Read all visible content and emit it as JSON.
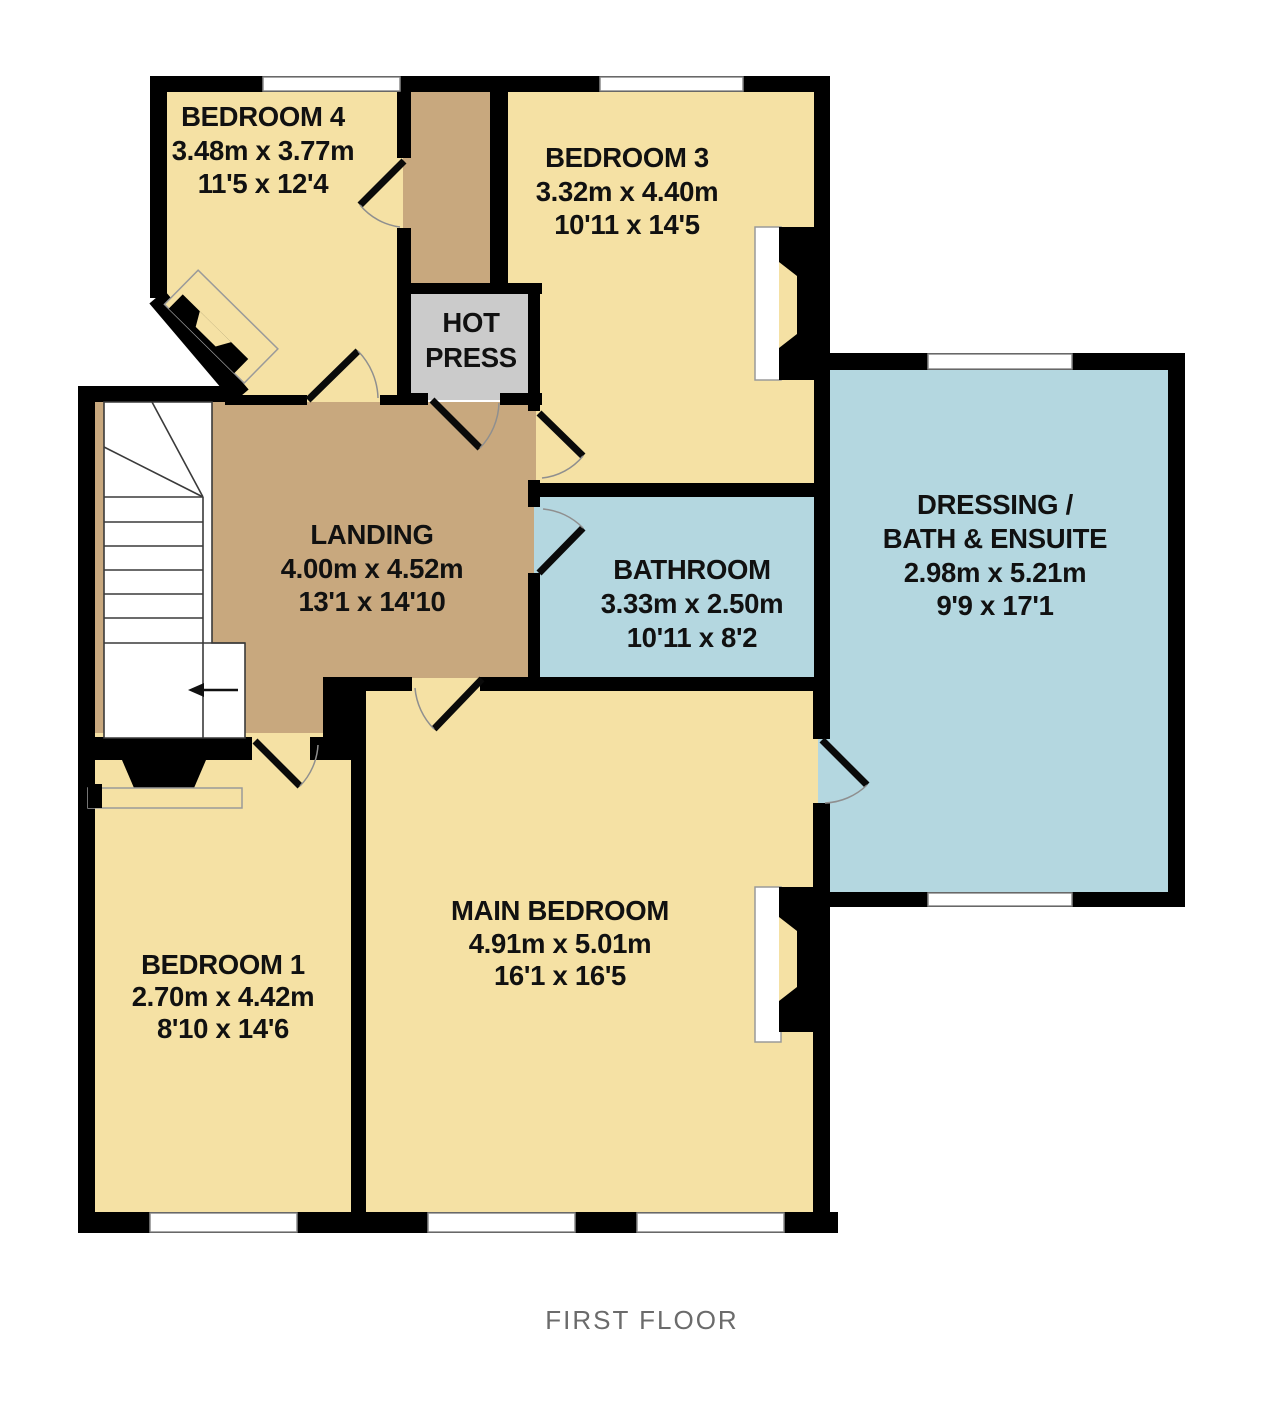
{
  "floorplan_title": "FIRST FLOOR",
  "rooms": [
    {
      "name": "BEDROOM 4",
      "metric": "3.48m x 3.77m",
      "imperial": "11'5 x 12'4"
    },
    {
      "name": "BEDROOM 3",
      "metric": "3.32m x 4.40m",
      "imperial": "10'11 x 14'5"
    },
    {
      "name": "HOT",
      "name2": "PRESS"
    },
    {
      "name": "LANDING",
      "metric": "4.00m x 4.52m",
      "imperial": "13'1 x 14'10"
    },
    {
      "name": "BATHROOM",
      "metric": "3.33m x 2.50m",
      "imperial": "10'11 x 8'2"
    },
    {
      "name": "DRESSING /",
      "name2": "BATH & ENSUITE",
      "metric": "2.98m x 5.21m",
      "imperial": "9'9 x 17'1"
    },
    {
      "name": "BEDROOM 1",
      "metric": "2.70m x 4.42m",
      "imperial": "8'10 x 14'6"
    },
    {
      "name": "MAIN BEDROOM",
      "metric": "4.91m x 5.01m",
      "imperial": "16'1 x 16'5"
    }
  ],
  "colors": {
    "bedroom_cream": "#F5E1A4",
    "landing_brown": "#C8A87E",
    "wet_room_blue": "#B4D7E0",
    "hot_press_gray": "#CBCBCB",
    "wall_black": "#000000",
    "window_white": "#FFFFFF",
    "title_gray": "#6B6B6B"
  }
}
